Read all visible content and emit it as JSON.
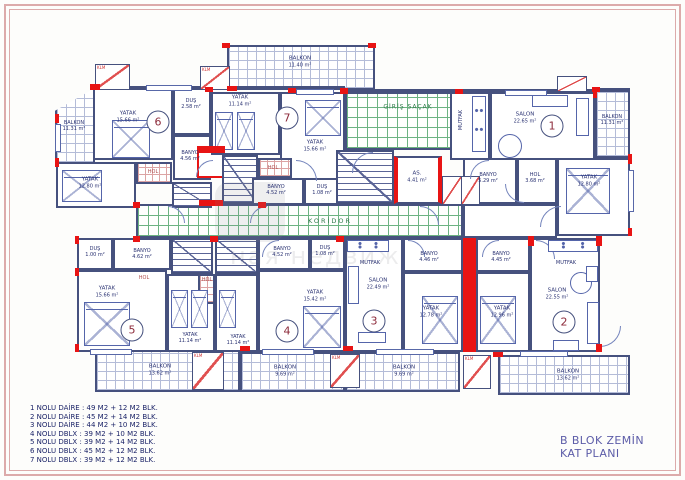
{
  "sheet": {
    "title_line1": "B BLOK ZEMİN",
    "title_line2": "KAT PLANI",
    "watermark": "ная недвиж",
    "legend": [
      "1 NOLU DAİRE : 49 M2 + 12 M2 BLK.",
      "2 NOLU DAİRE : 45 M2 + 14 M2 BLK.",
      "3 NOLU DAİRE : 44 M2 + 10 M2 BLK.",
      "4 NOLU DBLX : 39 M2 + 10 M2 BLK.",
      "5 NOLU DBLX : 39 M2 + 14 M2 BLK.",
      "6 NOLU DBLX : 45 M2 + 12 M2 BLK.",
      "7 NOLU DBLX : 39 M2 + 12 M2 BLK."
    ]
  },
  "rooms": {
    "balkon_top": {
      "name": "BALKON",
      "area": "11.40 m²"
    },
    "balkon_left": {
      "name": "BALKON",
      "area": "11.31 m²"
    },
    "balkon_right": {
      "name": "BALKON",
      "area": "11.31 m²"
    },
    "balkon_bl": {
      "name": "BALKON",
      "area": "13.62 m²"
    },
    "balkon_bml": {
      "name": "BALKON",
      "area": "9.69 m²"
    },
    "balkon_bmr": {
      "name": "BALKON",
      "area": "9.69 m²"
    },
    "balkon_br": {
      "name": "BALKON",
      "area": "13.62 m²"
    },
    "giris": {
      "name": "GİRİŞ SAÇAK"
    },
    "koridor": {
      "name": "KORİDOR"
    },
    "asansor": {
      "name": "AS.",
      "area": "4.41 m²"
    },
    "yatak6": {
      "name": "YATAK",
      "area": "15.66 m²"
    },
    "dus6": {
      "name": "DUŞ",
      "area": "2.58 m²"
    },
    "banyo6": {
      "name": "BANYO",
      "area": "4.56 m²"
    },
    "yatak6b": {
      "name": "YATAK",
      "area": "12.80 m²"
    },
    "hol6": {
      "name": "HOL"
    },
    "yatak7a": {
      "name": "YATAK",
      "area": "11.14 m²"
    },
    "yatak7b": {
      "name": "YATAK",
      "area": "15.66 m²"
    },
    "hol7": {
      "name": "HOL"
    },
    "banyo7": {
      "name": "BANYO",
      "area": "4.52 m²"
    },
    "dus7": {
      "name": "DUŞ",
      "area": "1.08 m²"
    },
    "mutfak1": {
      "name": "MUTFAK"
    },
    "salon1": {
      "name": "SALON",
      "area": "22.65 m²"
    },
    "banyo1": {
      "name": "BANYO",
      "area": "5.29 m²"
    },
    "hol1": {
      "name": "HOL",
      "area": "3.68 m²"
    },
    "yatak1": {
      "name": "YATAK",
      "area": "12.80 m²"
    },
    "dus5": {
      "name": "DUŞ",
      "area": "1.00 m²"
    },
    "banyo5": {
      "name": "BANYO",
      "area": "4.62 m²"
    },
    "hol5": {
      "name": "HOL"
    },
    "yatak5a": {
      "name": "YATAK",
      "area": "15.66 m²"
    },
    "yatak5b": {
      "name": "YATAK",
      "area": "11.14 m²"
    },
    "banyo4": {
      "name": "BANYO",
      "area": "4.52 m²"
    },
    "dus4": {
      "name": "DUŞ",
      "area": "1.08 m²"
    },
    "hol4": {
      "name": "HOL"
    },
    "yatak4a": {
      "name": "YATAK",
      "area": "15.42 m²"
    },
    "yatak4b": {
      "name": "YATAK",
      "area": "11.14 m²"
    },
    "mutfak3": {
      "name": "MUTFAK"
    },
    "salon3": {
      "name": "SALON",
      "area": "22.49 m²"
    },
    "banyo3": {
      "name": "BANYO",
      "area": "4.46 m²"
    },
    "yatak3": {
      "name": "YATAK",
      "area": "12.78 m²"
    },
    "banyo2": {
      "name": "BANYO",
      "area": "4.45 m²"
    },
    "yatak2": {
      "name": "YATAK",
      "area": "12.96 m²"
    },
    "mutfak2": {
      "name": "MUTFAK"
    },
    "salon2": {
      "name": "SALON",
      "area": "22.55 m²"
    }
  },
  "units": {
    "u1": "1",
    "u2": "2",
    "u3": "3",
    "u4": "4",
    "u5": "5",
    "u6": "6",
    "u7": "7"
  },
  "annotations": {
    "klm": "KLM"
  },
  "colors": {
    "wall": "#46517e",
    "accent_red": "#e81414",
    "hatch_green": "#3f9e57",
    "text_navy": "#2a3272",
    "title_blue": "#5c5ca8",
    "frame_pink": "#dcaaaa"
  }
}
